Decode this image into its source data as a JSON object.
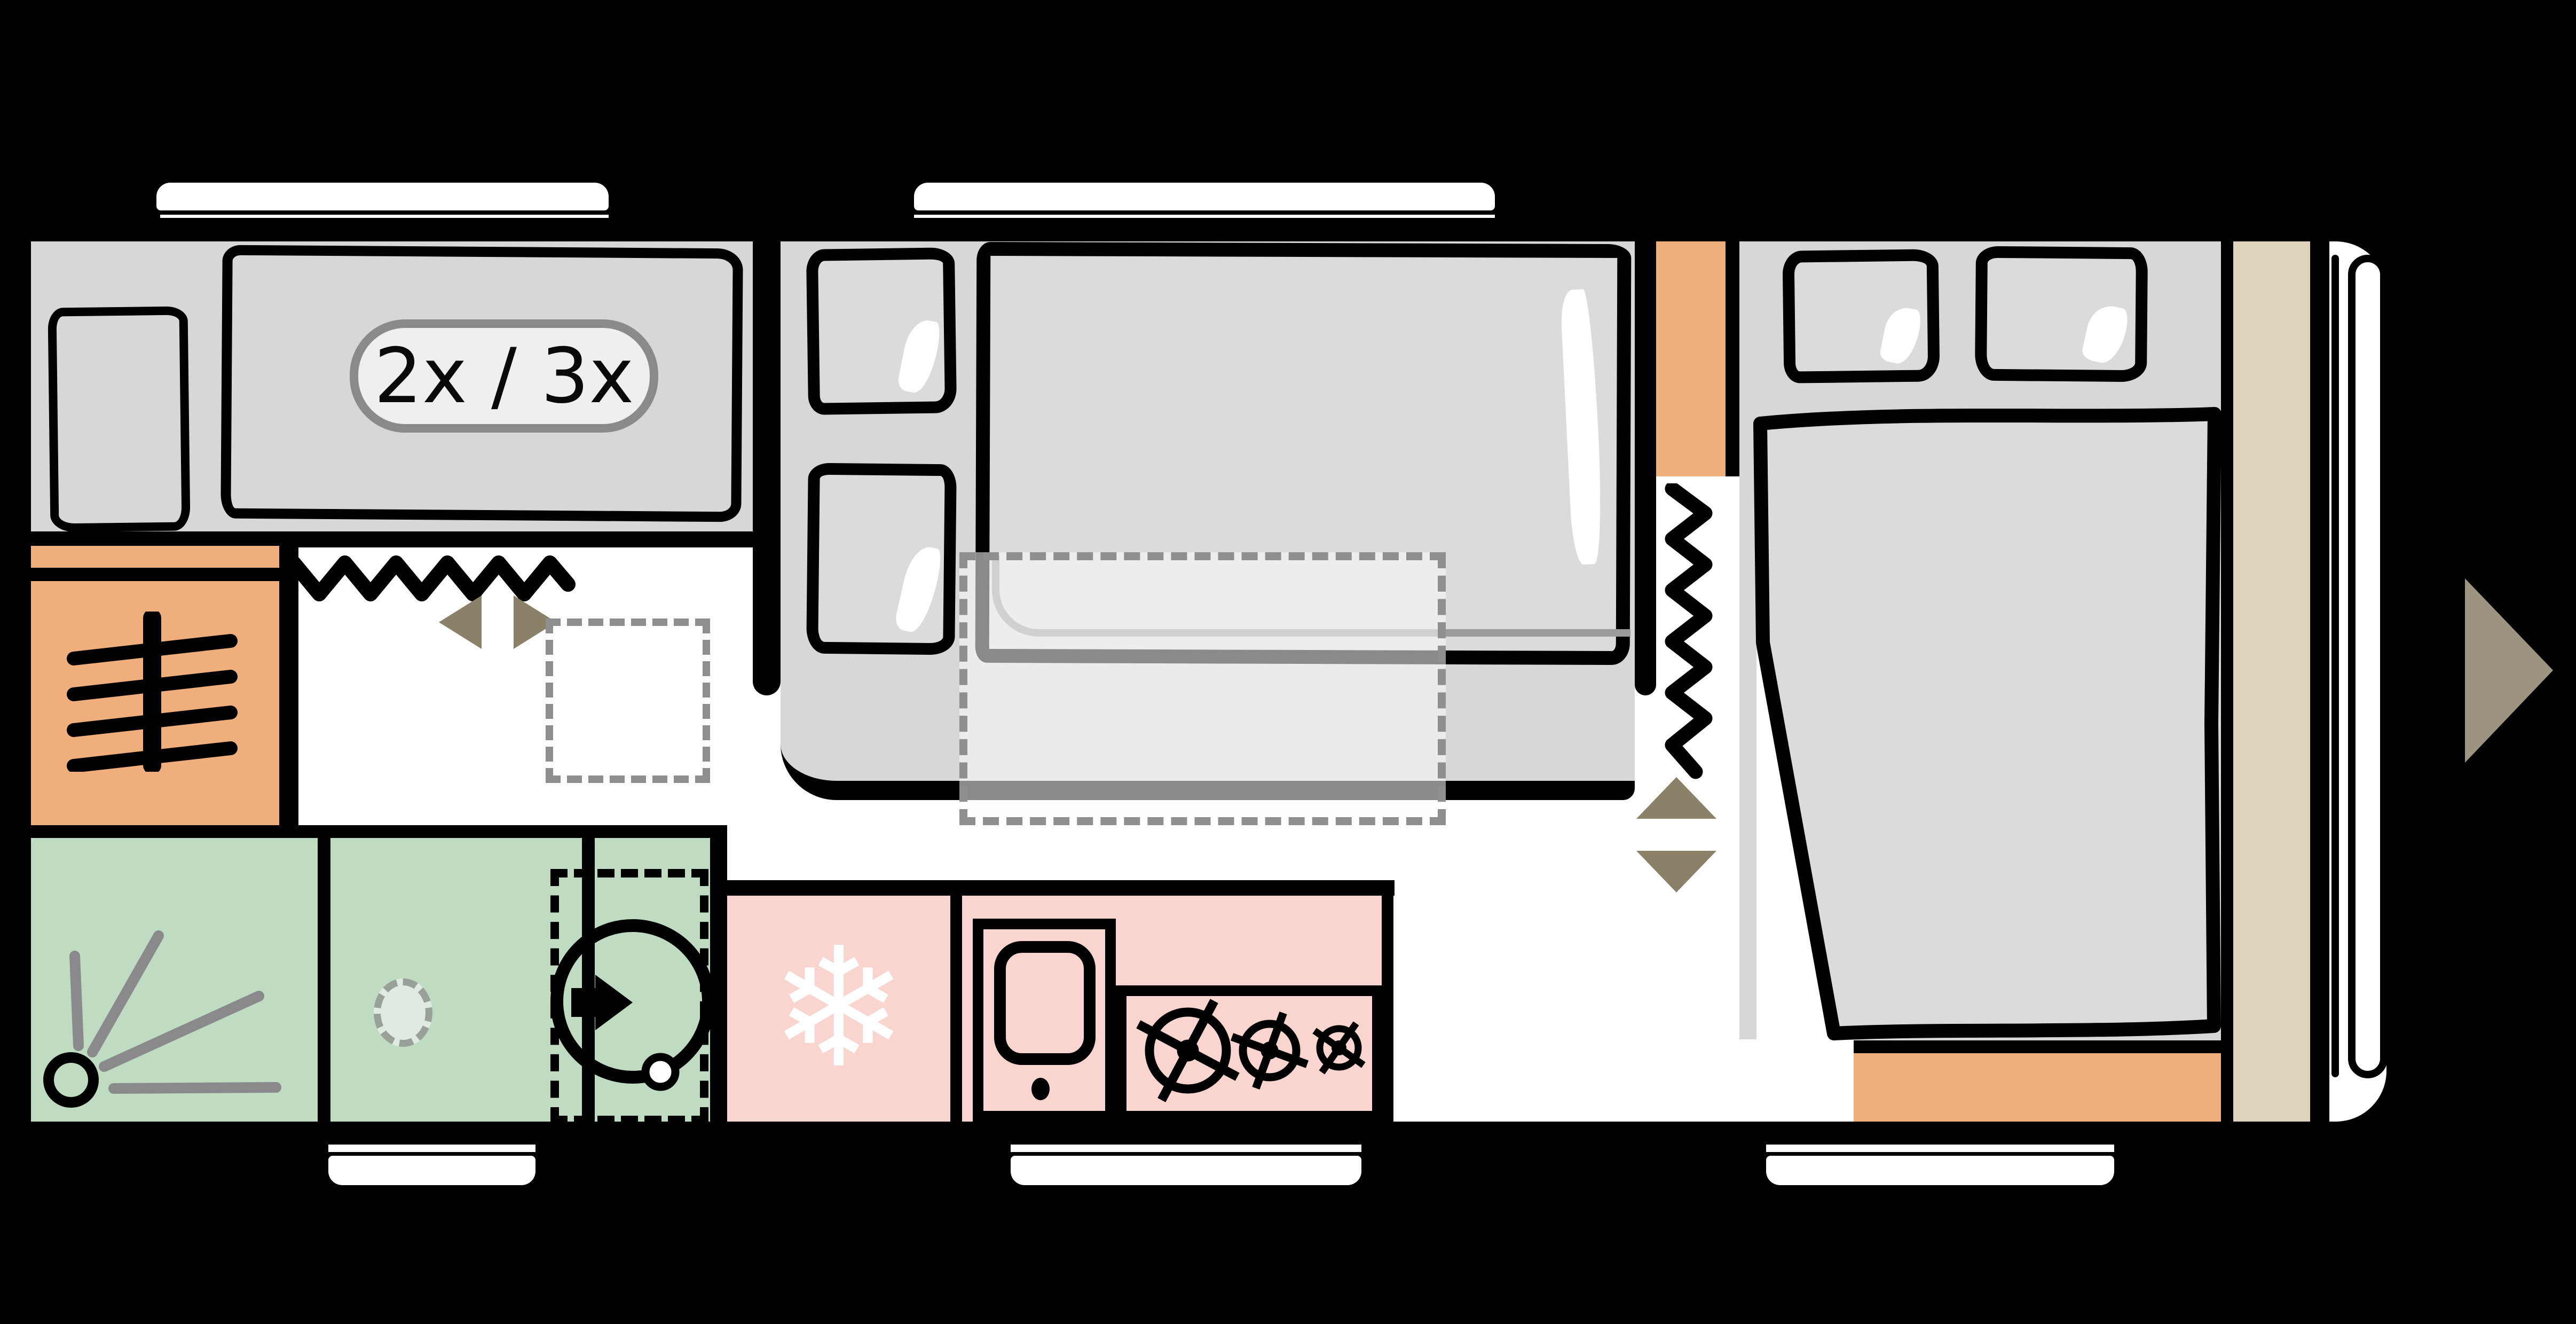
{
  "type": "caravan-floorplan-diagram",
  "badge": {
    "label": "2x / 3x"
  },
  "snowflake_glyph": "❄",
  "colors": {
    "background": "#000000",
    "floor": "#FFFFFF",
    "wall": "#000000",
    "furniture-gray": "#D7D7D9",
    "soft-gray": "#DBDBDD",
    "orange": "#EFAE7C",
    "green": "#BFDCC3",
    "green-light": "#DFEBE0",
    "pink": "#FAD5D0",
    "beige": "#DED4BC",
    "olive": "#8A8168",
    "olive-light": "#9C9480",
    "dash-gray": "#8F8F92",
    "line-gray": "#9B9B9E",
    "drain-gray": "#98A098",
    "ray-gray": "#8A8A8C",
    "badge-fill": "#EFEFEF",
    "badge-border": "#8A8A8D"
  },
  "icons": [
    {
      "name": "heater-icon",
      "meaning": "heater in left wardrobe column"
    },
    {
      "name": "shower-icon",
      "meaning": "shower head with spray"
    },
    {
      "name": "floor-drain-icon",
      "meaning": "shower drain"
    },
    {
      "name": "toilet-icon",
      "meaning": "swivel toilet with rotation arrow"
    },
    {
      "name": "snowflake-icon",
      "meaning": "refrigerator"
    },
    {
      "name": "sink-icon",
      "meaning": "kitchen sink with drain"
    },
    {
      "name": "hob-burners-icon",
      "meaning": "three gas burners"
    },
    {
      "name": "flex-wall-zigzag-icon",
      "meaning": "concertina partition (2x)"
    },
    {
      "name": "sliding-door-arrows-icon",
      "meaning": "sliding door opens left/right"
    },
    {
      "name": "lift-bed-arrows-icon",
      "meaning": "bed lifts up/down"
    },
    {
      "name": "entry-arrow-icon",
      "meaning": "entrance door marker"
    },
    {
      "name": "dropdown-bed-dashed",
      "meaning": "fold-down bunk outline"
    },
    {
      "name": "shower-tray-dashed",
      "meaning": "optional shower tray outline"
    }
  ]
}
